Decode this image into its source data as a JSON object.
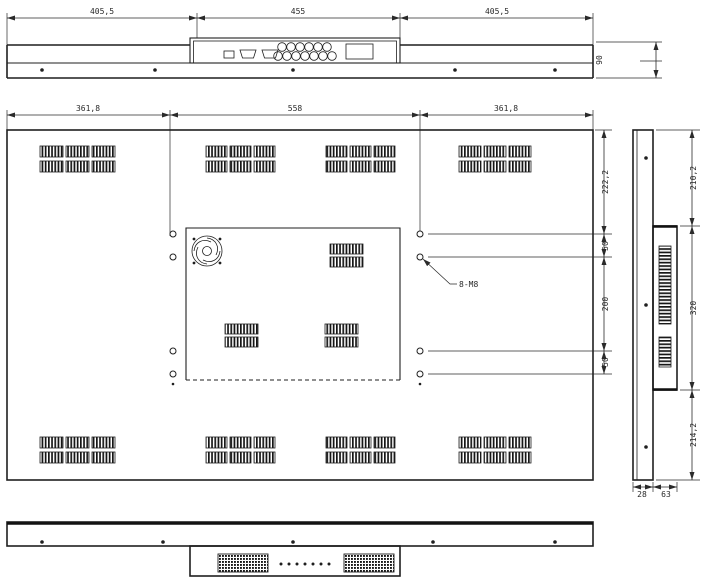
{
  "top_view": {
    "dim_left": "405,5",
    "dim_center": "455",
    "dim_right": "405,5",
    "dim_depth": "90"
  },
  "rear_view": {
    "dim_left": "361,8",
    "dim_center": "558",
    "dim_right": "361,8",
    "dim_v_top": "222,2",
    "dim_v_gap_top": "50",
    "dim_v_span": "200",
    "dim_v_gap_bottom": "50",
    "mount_holes_label": "8-M8"
  },
  "side_view": {
    "dim_v_top": "210,2",
    "dim_v_mid": "320",
    "dim_v_bottom": "214,2",
    "dim_depth_front": "28",
    "dim_depth_back": "63"
  },
  "colors": {
    "line": "#1f1f1f",
    "text": "#2a2a2a",
    "background": "#ffffff"
  }
}
